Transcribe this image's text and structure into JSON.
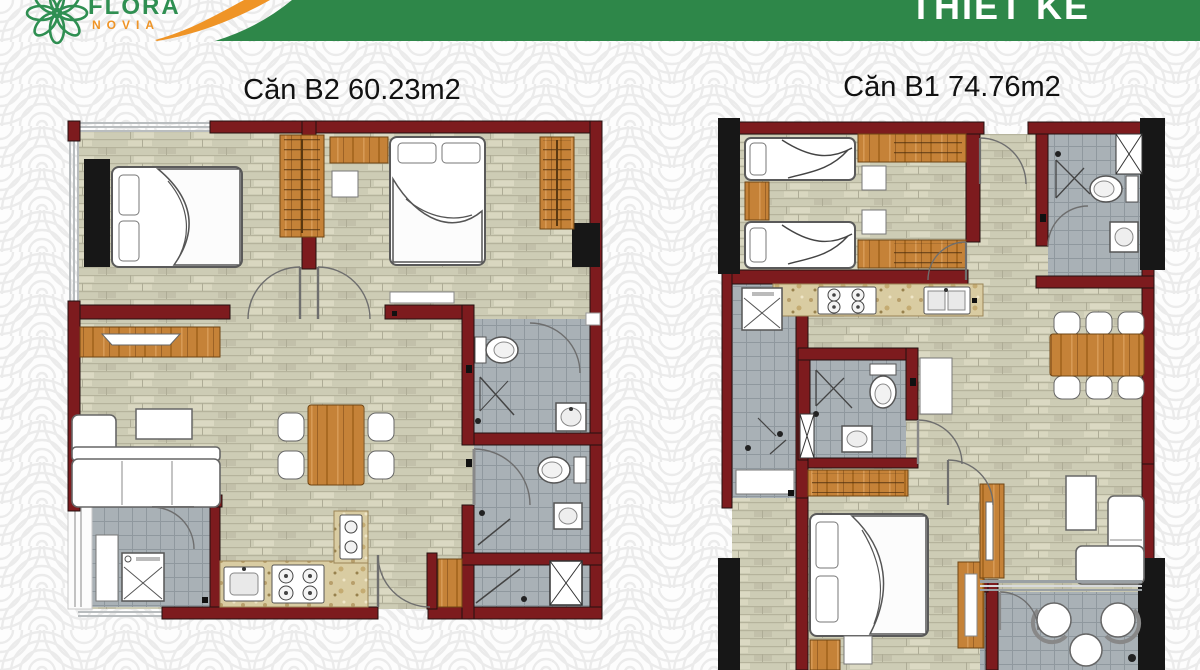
{
  "header": {
    "logo": {
      "brand": "FLORA",
      "sub_brand": "NOVIA"
    },
    "banner": {
      "title": "THIẾT KẾ"
    }
  },
  "plans": [
    {
      "id": "B2",
      "title": "Căn B2 60.23m2",
      "unit": "Căn B2",
      "area": "60.23m2"
    },
    {
      "id": "B1",
      "title": "Căn B1 74.76m2",
      "unit": "Căn B1",
      "area": "74.76m2"
    }
  ],
  "palette": {
    "banner_green": "#2e8749",
    "logo_green": "#2f8f52",
    "accent_orange": "#ef9426",
    "wall_red": "#7d1b1e",
    "column_black": "#171717",
    "floor_wood": "#cdccb5",
    "tile_gray": "#a9b1b6",
    "furniture_wood": "#c58238",
    "counter_marble": "#d9cca2",
    "pattern_gray": "#ebebeb"
  }
}
